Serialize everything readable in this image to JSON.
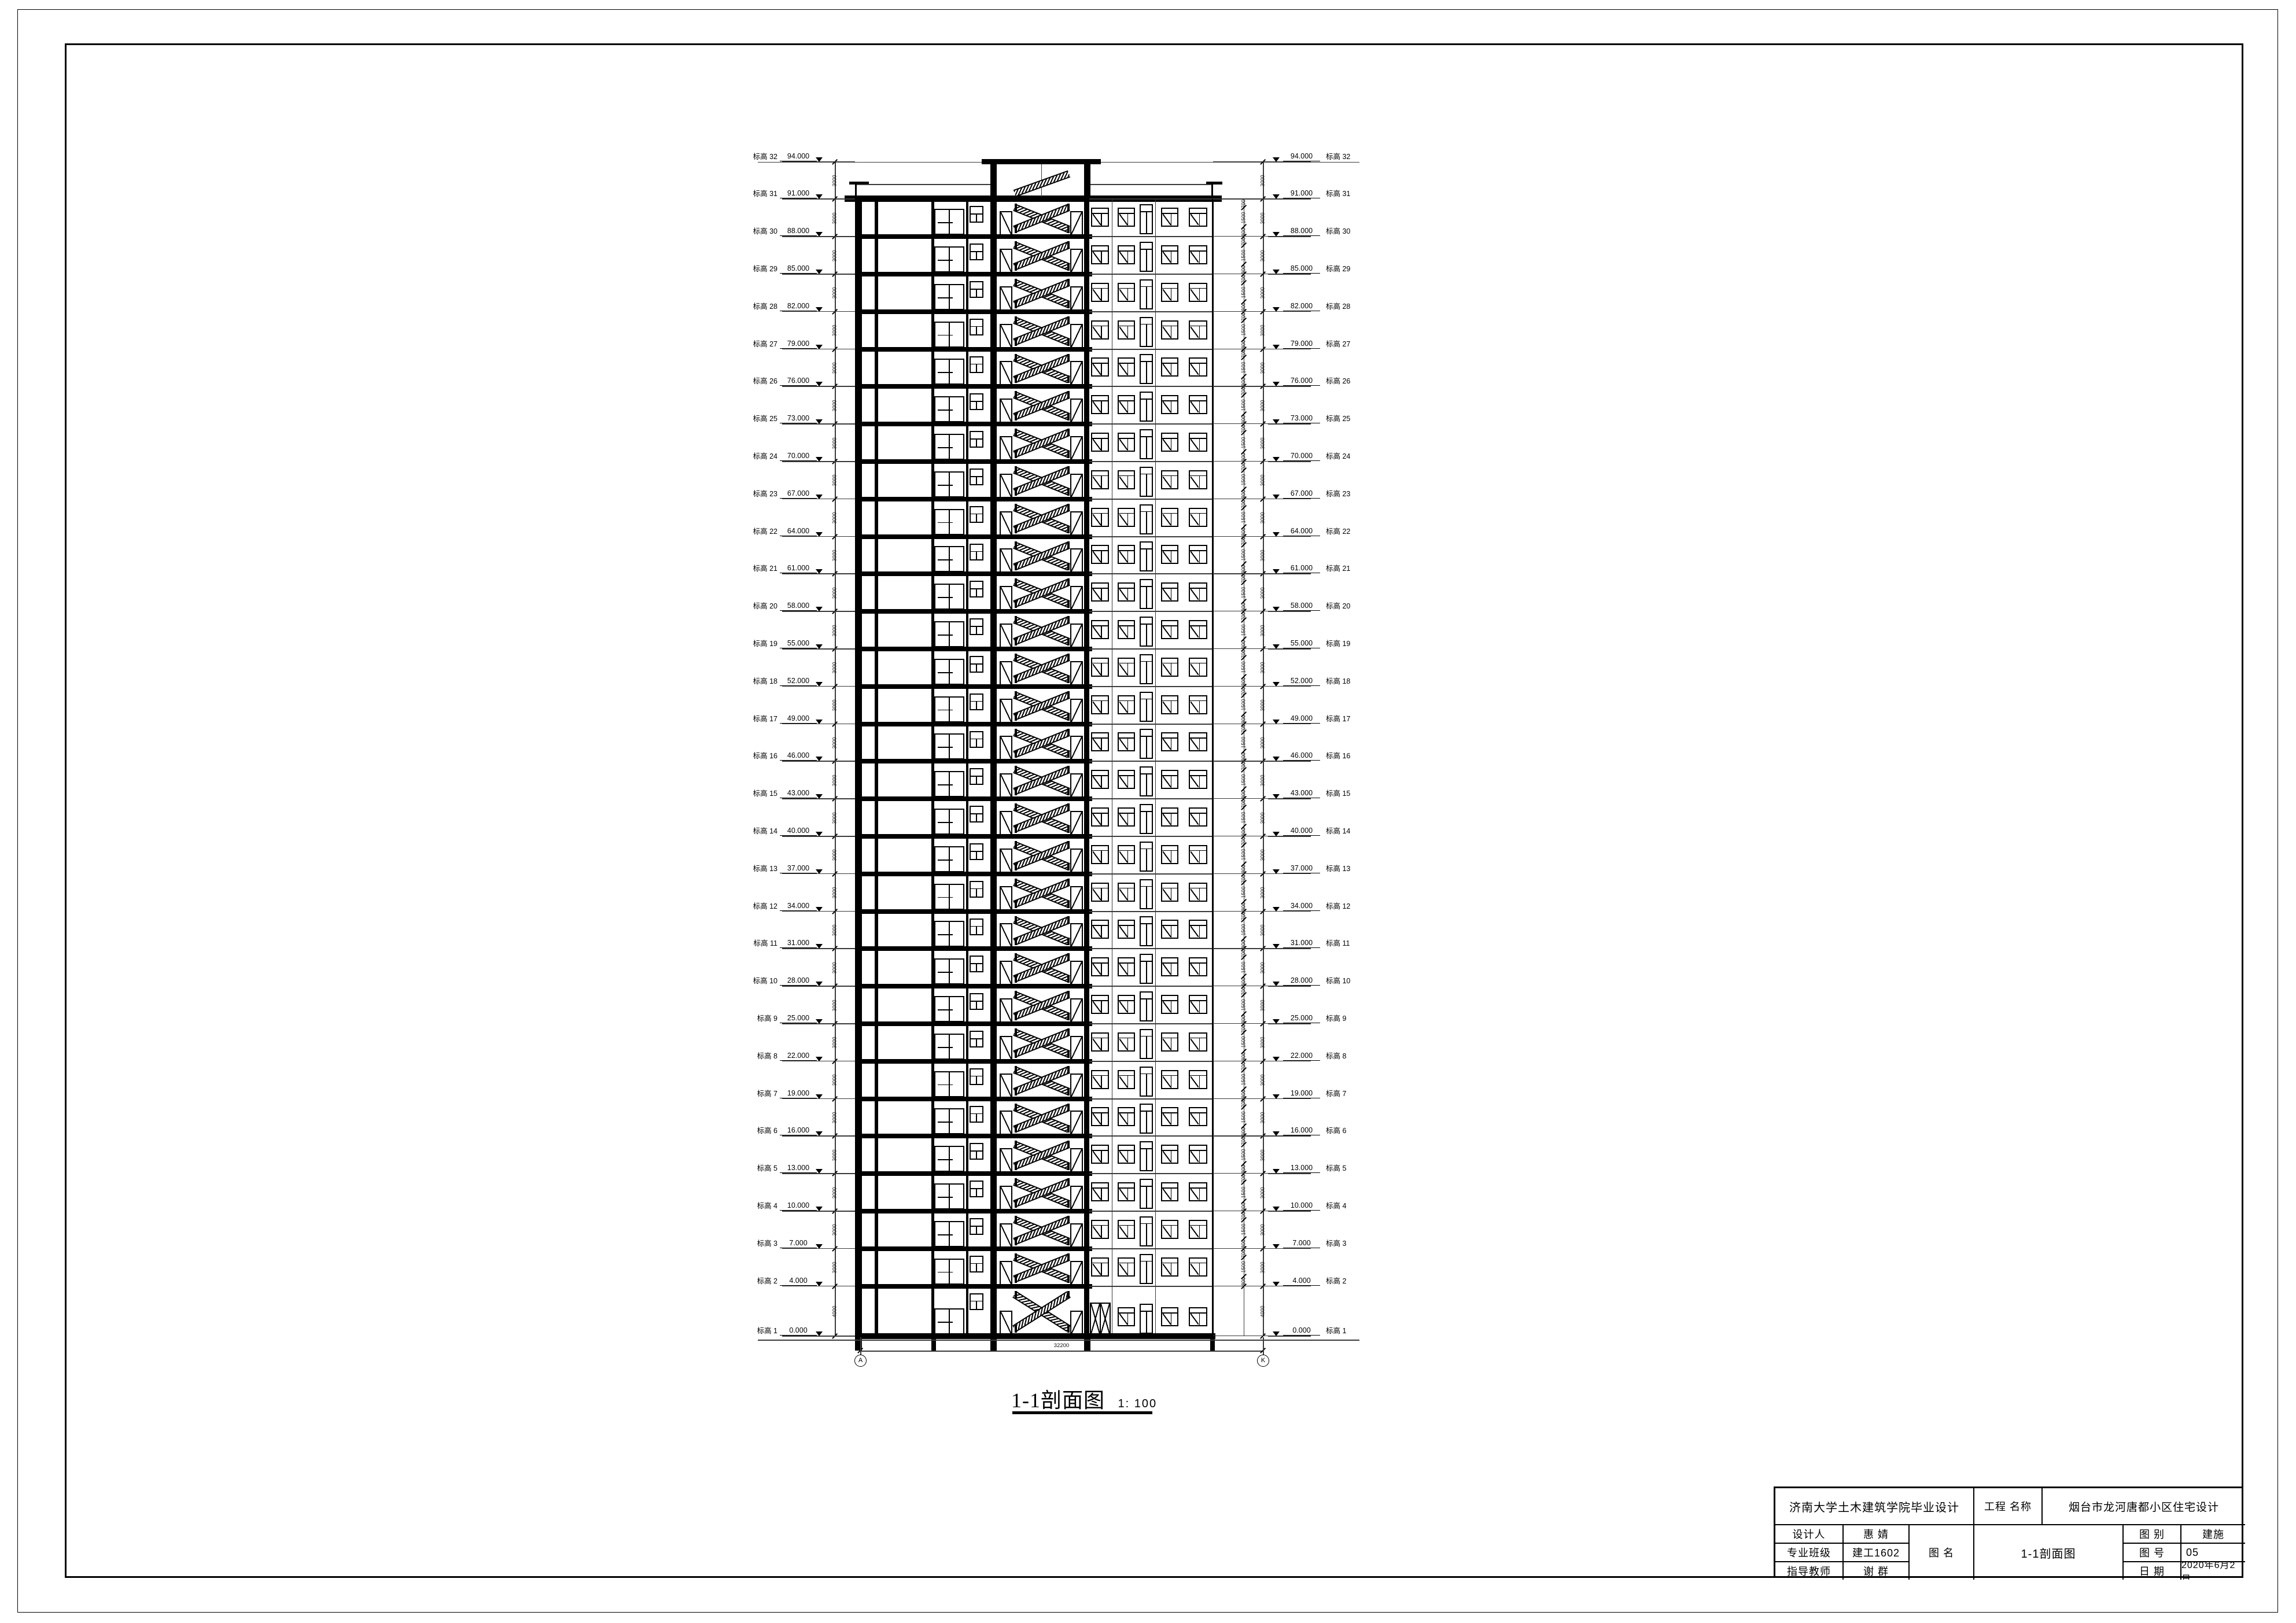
{
  "section": {
    "title": "1-1剖面图",
    "scale_prefix": "1:",
    "scale_value": "100",
    "level_prefix": "标高",
    "levels": [
      {
        "no": "1",
        "elev": "0.000"
      },
      {
        "no": "2",
        "elev": "4.000"
      },
      {
        "no": "3",
        "elev": "7.000"
      },
      {
        "no": "4",
        "elev": "10.000"
      },
      {
        "no": "5",
        "elev": "13.000"
      },
      {
        "no": "6",
        "elev": "16.000"
      },
      {
        "no": "7",
        "elev": "19.000"
      },
      {
        "no": "8",
        "elev": "22.000"
      },
      {
        "no": "9",
        "elev": "25.000"
      },
      {
        "no": "10",
        "elev": "28.000"
      },
      {
        "no": "11",
        "elev": "31.000"
      },
      {
        "no": "12",
        "elev": "34.000"
      },
      {
        "no": "13",
        "elev": "37.000"
      },
      {
        "no": "14",
        "elev": "40.000"
      },
      {
        "no": "15",
        "elev": "43.000"
      },
      {
        "no": "16",
        "elev": "46.000"
      },
      {
        "no": "17",
        "elev": "49.000"
      },
      {
        "no": "18",
        "elev": "52.000"
      },
      {
        "no": "19",
        "elev": "55.000"
      },
      {
        "no": "20",
        "elev": "58.000"
      },
      {
        "no": "21",
        "elev": "61.000"
      },
      {
        "no": "22",
        "elev": "64.000"
      },
      {
        "no": "23",
        "elev": "67.000"
      },
      {
        "no": "24",
        "elev": "70.000"
      },
      {
        "no": "25",
        "elev": "73.000"
      },
      {
        "no": "26",
        "elev": "76.000"
      },
      {
        "no": "27",
        "elev": "79.000"
      },
      {
        "no": "28",
        "elev": "82.000"
      },
      {
        "no": "29",
        "elev": "85.000"
      },
      {
        "no": "30",
        "elev": "88.000"
      },
      {
        "no": "31",
        "elev": "91.000"
      },
      {
        "no": "32",
        "elev": "94.000"
      }
    ],
    "dims": {
      "first_floor": "4000",
      "typical_floor": "3000",
      "parapet_storey": "3000",
      "window_band": [
        "800",
        "1500",
        "700"
      ],
      "overall_width": "32200"
    },
    "grid_bubbles": {
      "left": "A",
      "right": "K"
    }
  },
  "titleblock": {
    "school": "济南大学土木建筑学院毕业设计",
    "project_label": "工程  名称",
    "project_name": "烟台市龙河唐都小区住宅设计",
    "designer_label": "设计人",
    "designer": "惠 婧",
    "class_label": "专业班级",
    "class_value": "建工1602",
    "advisor_label": "指导教师",
    "advisor": "谢 群",
    "drawing_name_label": "图  名",
    "drawing_name": "1-1剖面图",
    "category_label": "图  别",
    "category": "建施",
    "number_label": "图  号",
    "number": "05",
    "date_label": "日  期",
    "date": "2020年6月2日"
  }
}
